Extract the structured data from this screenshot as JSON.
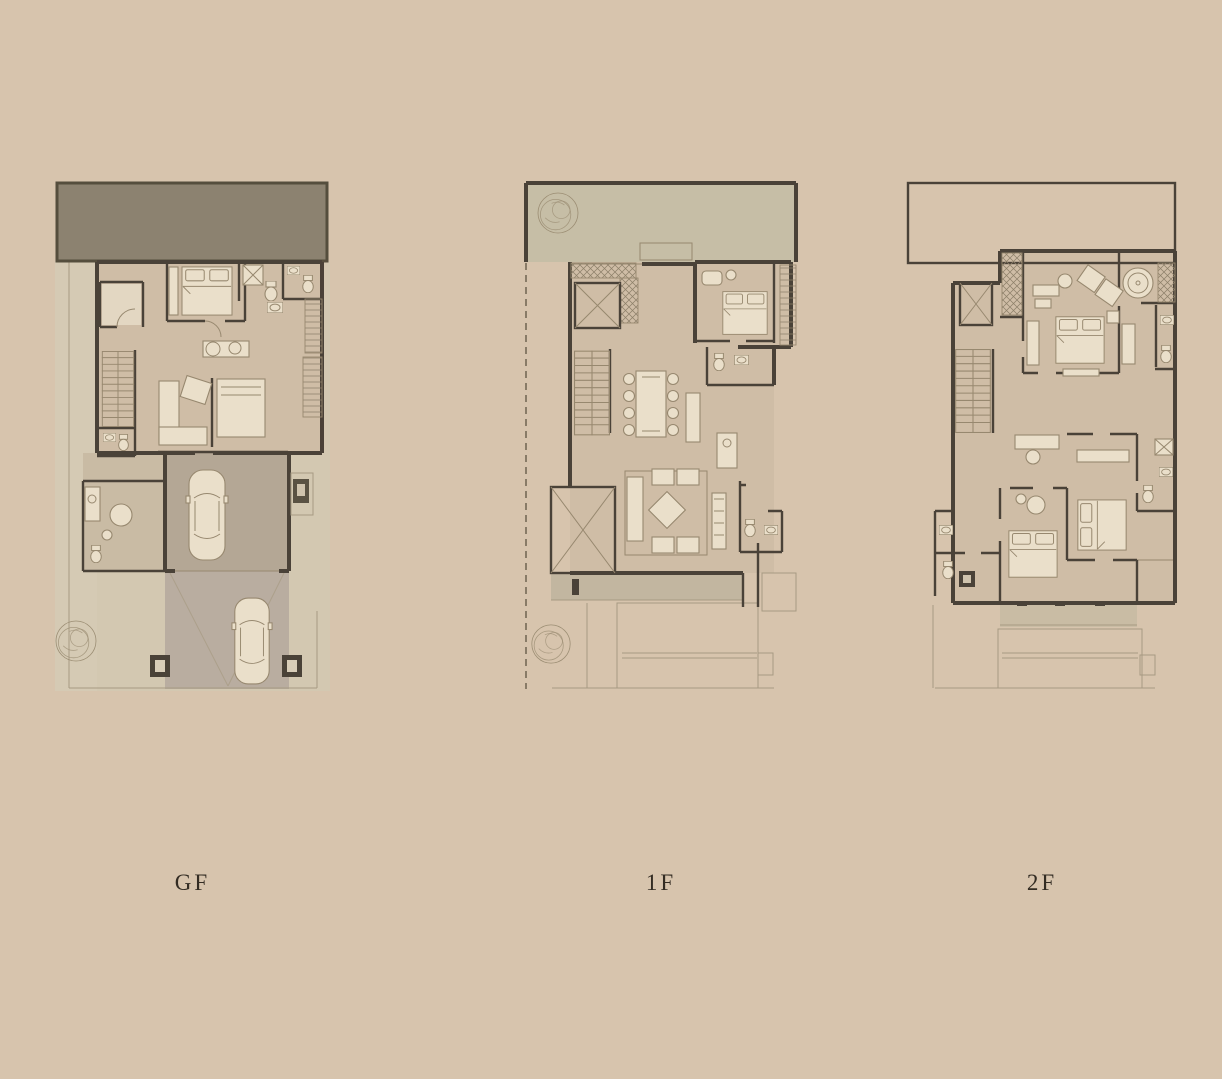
{
  "page": {
    "background": "#d7c4ad"
  },
  "plans": [
    {
      "id": "gf",
      "label": "GF"
    },
    {
      "id": "1f",
      "label": "1F"
    },
    {
      "id": "2f",
      "label": "2F"
    }
  ],
  "colors": {
    "bg": "#d7c4ad",
    "wall": "#4a4238",
    "band": "#8c8270",
    "bandEdge": "#554e3d",
    "interior": "#cfbda6",
    "terrace": "#c6bea6",
    "garage": "#b4a795",
    "driveway": "#b9ada0",
    "site": "#d3c8b1",
    "furn": "#eadfca",
    "furnStroke": "#97886f",
    "ghost": "#a79a82",
    "rug": "#d6c9b2",
    "hatch": "#8d8069",
    "label": "#332c23"
  }
}
